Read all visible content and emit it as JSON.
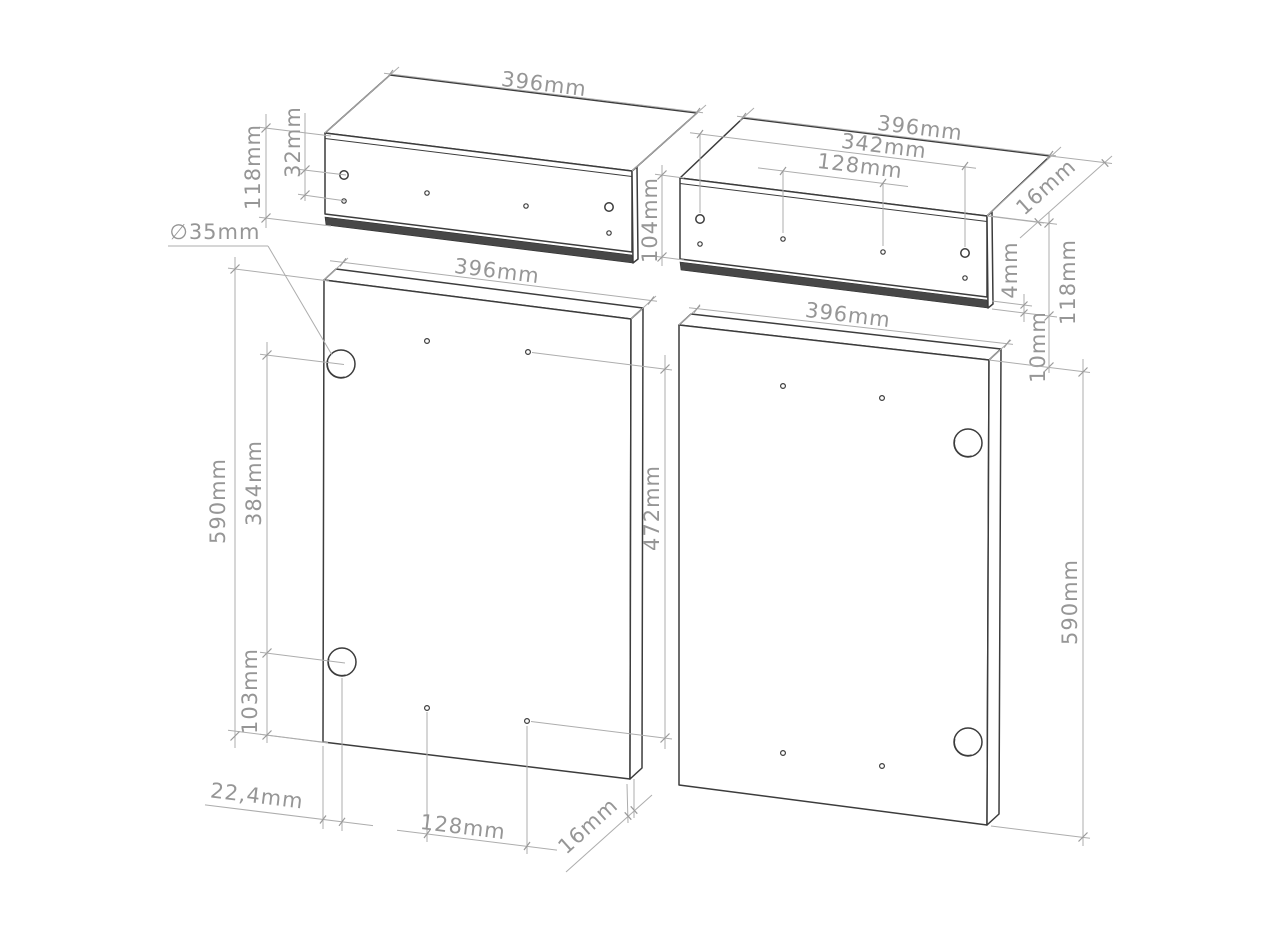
{
  "canvas": {
    "background": "#ffffff",
    "edge_color": "#3c3c3c",
    "dim_line_color": "#adadad",
    "label_color": "#969696",
    "unit": "mm"
  },
  "dimensions": {
    "p1_width": {
      "label": "396mm"
    },
    "p1_height": {
      "label": "118mm"
    },
    "p1_hole_offset": {
      "label": "32mm"
    },
    "hinge_diameter": {
      "label": "∅35mm"
    },
    "p2_width": {
      "label": "396mm"
    },
    "p2_row_span": {
      "label": "342mm"
    },
    "p2_hole_pitch": {
      "label": "128mm"
    },
    "p2_edge_depth": {
      "label": "16mm"
    },
    "p2_face_height": {
      "label": "104mm"
    },
    "p2_groove": {
      "label": "4mm"
    },
    "p2_height": {
      "label": "118mm"
    },
    "p2_gap_below": {
      "label": "10mm"
    },
    "p3_width": {
      "label": "396mm"
    },
    "p3_height": {
      "label": "590mm"
    },
    "p3_hinge_pitch": {
      "label": "384mm"
    },
    "p3_hinge_bottom": {
      "label": "103mm"
    },
    "p3_right_span": {
      "label": "472mm"
    },
    "p3_hinge_edge": {
      "label": "22,4mm"
    },
    "p3_bottom_pitch": {
      "label": "128mm"
    },
    "p3_thickness": {
      "label": "16mm"
    },
    "p4_width": {
      "label": "396mm"
    },
    "p4_height": {
      "label": "590mm"
    }
  }
}
